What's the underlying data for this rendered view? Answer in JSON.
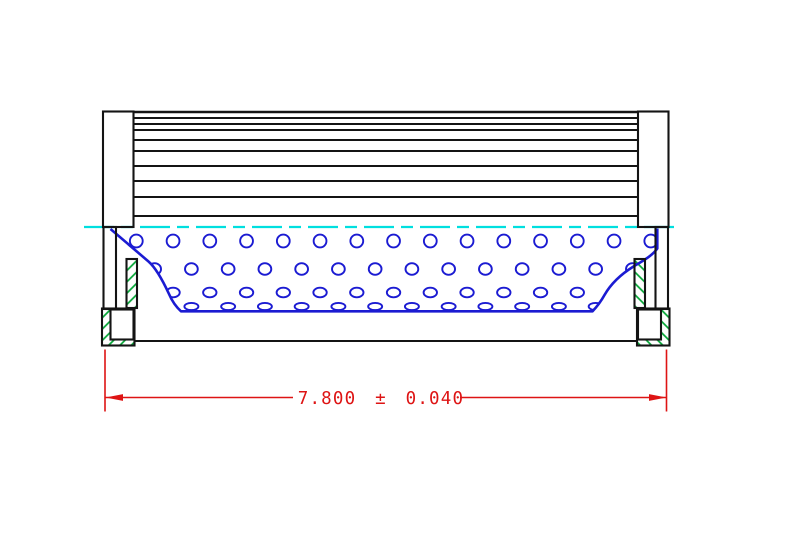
{
  "drawing": {
    "background": "#ffffff",
    "colors": {
      "outline": "#141414",
      "core": "#1b1bd2",
      "centerline": "#00dfdf",
      "hatch": "#00a432",
      "dimension": "#de1414"
    },
    "dimension": {
      "label": "7.800 ± 0.040",
      "nominal": "7.800",
      "tolerance": "0.040"
    },
    "pleats": {
      "x1": 133.5,
      "x2": 638,
      "line_ys": [
        112,
        118,
        124,
        130,
        140,
        151,
        166,
        181,
        197,
        216
      ]
    },
    "centerline": {
      "y": 227,
      "x1": 84,
      "x2": 678,
      "dash": "30 7 12 7"
    },
    "holes": {
      "x_start": 136.3,
      "pitch": 36.75,
      "stagger_dx": -18.4,
      "count": 16,
      "rows": [
        {
          "cy": 241,
          "rx": 6.4,
          "ry": 6.4,
          "stagger": false
        },
        {
          "cy": 269,
          "rx": 6.4,
          "ry": 5.8,
          "stagger": true
        },
        {
          "cy": 292.5,
          "rx": 6.7,
          "ry": 4.8,
          "stagger": false
        },
        {
          "cy": 306.5,
          "rx": 7.0,
          "ry": 3.6,
          "stagger": true
        }
      ]
    }
  }
}
